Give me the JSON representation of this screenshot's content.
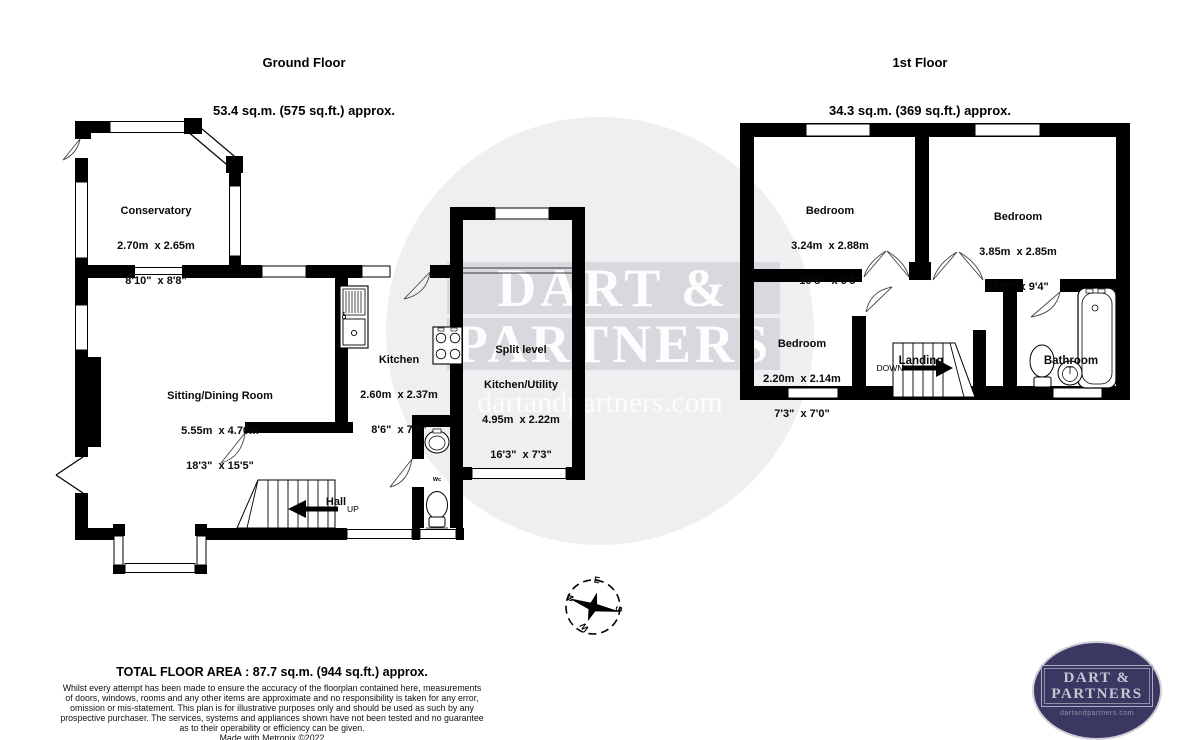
{
  "ground_floor": {
    "title": "Ground Floor",
    "subtitle": "53.4 sq.m. (575 sq.ft.) approx.",
    "rooms": {
      "conservatory": {
        "name": "Conservatory",
        "metric": "2.70m  x 2.65m",
        "imperial": "8'10\"  x 8'8\""
      },
      "sitting_dining": {
        "name": "Sitting/Dining Room",
        "metric": "5.55m  x 4.70m",
        "imperial": "18'3\"  x 15'5\""
      },
      "kitchen": {
        "name": "Kitchen",
        "metric": "2.60m  x 2.37m",
        "imperial": "8'6\"  x 7'9\""
      },
      "utility": {
        "name_line1": "Split level",
        "name_line2": "Kitchen/Utility",
        "metric": "4.95m  x 2.22m",
        "imperial": "16'3\"  x 7'3\""
      },
      "hall": {
        "name": "Hall"
      },
      "wc": {
        "name": "Wc"
      }
    },
    "stairs_label": "UP"
  },
  "first_floor": {
    "title": "1st Floor",
    "subtitle": "34.3 sq.m. (369 sq.ft.) approx.",
    "rooms": {
      "bedroom1": {
        "name": "Bedroom",
        "metric": "3.24m  x 2.88m",
        "imperial": "10'8\"  x 9'5\""
      },
      "bedroom2": {
        "name": "Bedroom",
        "metric": "3.85m  x 2.85m",
        "imperial": "12'8\"  x 9'4\""
      },
      "bedroom3": {
        "name": "Bedroom",
        "metric": "2.20m  x 2.14m",
        "imperial": "7'3\"  x 7'0\""
      },
      "landing": {
        "name": "Landing"
      },
      "bathroom": {
        "name": "Bathroom"
      }
    },
    "stairs_label": "DOWN"
  },
  "compass": {
    "north": "N",
    "east": "E",
    "south": "S",
    "west": "W"
  },
  "watermark": {
    "line1": "DART &",
    "line2": "PARTNERS",
    "website": "dartandpartners.com"
  },
  "footer": {
    "total_area": "TOTAL FLOOR AREA : 87.7 sq.m. (944 sq.ft.) approx.",
    "disclaimer_lines": [
      "Whilst every attempt has been made to ensure the accuracy of the floorplan contained here, measurements",
      "of doors, windows, rooms and any other items are approximate and no responsibility is taken for any error,",
      "omission or mis-statement. This plan is for illustrative purposes only and should be used as such by any",
      "prospective purchaser. The services, systems and appliances shown have not been tested and no guarantee",
      "as to their operability or efficiency can be given."
    ],
    "credit": "Made with Metropix ©2022"
  },
  "logo": {
    "line1": "DART &",
    "line2": "PARTNERS",
    "website": "dartandpartners.com"
  },
  "colors": {
    "wall": "#000000",
    "logo_bg": "#3a3862",
    "logo_text": "#c6c6d2",
    "watermark_tint": "rgba(44,44,80,0.075)"
  }
}
